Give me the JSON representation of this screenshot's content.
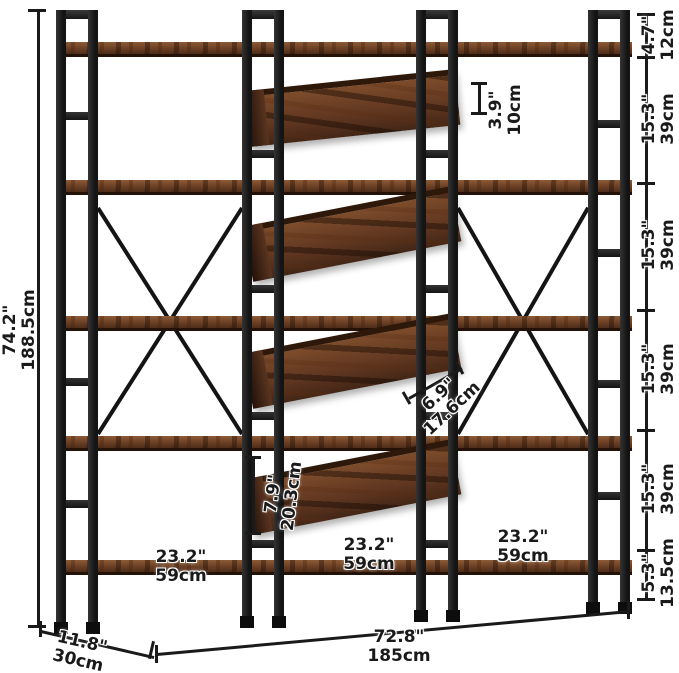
{
  "colors": {
    "frame": "#1a1a1a",
    "wood": "#6b3f24",
    "wood_dark": "#2e1809",
    "dimension_text": "#1a1a1a",
    "background": "#ffffff"
  },
  "dimensions": {
    "overall_height": {
      "inches": "74.2\"",
      "cm": "188.5cm"
    },
    "overall_width": {
      "inches": "72.8\"",
      "cm": "185cm"
    },
    "overall_depth": {
      "inches": "11.8\"",
      "cm": "30cm"
    },
    "right_segments": [
      {
        "inches": "4.7\"",
        "cm": "12cm"
      },
      {
        "inches": "15.3\"",
        "cm": "39cm"
      },
      {
        "inches": "15.3\"",
        "cm": "39cm"
      },
      {
        "inches": "15.3\"",
        "cm": "39cm"
      },
      {
        "inches": "15.3\"",
        "cm": "39cm"
      },
      {
        "inches": "5.3\"",
        "cm": "13.5cm"
      }
    ],
    "bin_back_height": {
      "inches": "3.9\"",
      "cm": "10cm"
    },
    "bin_slant_depth": {
      "inches": "6.9\"",
      "cm": "17.6cm"
    },
    "bin_front_height": {
      "inches": "7.9\"",
      "cm": "20.3cm"
    },
    "shelf_widths": [
      {
        "inches": "23.2\"",
        "cm": "59cm"
      },
      {
        "inches": "23.2\"",
        "cm": "59cm"
      },
      {
        "inches": "23.2\"",
        "cm": "59cm"
      }
    ]
  }
}
